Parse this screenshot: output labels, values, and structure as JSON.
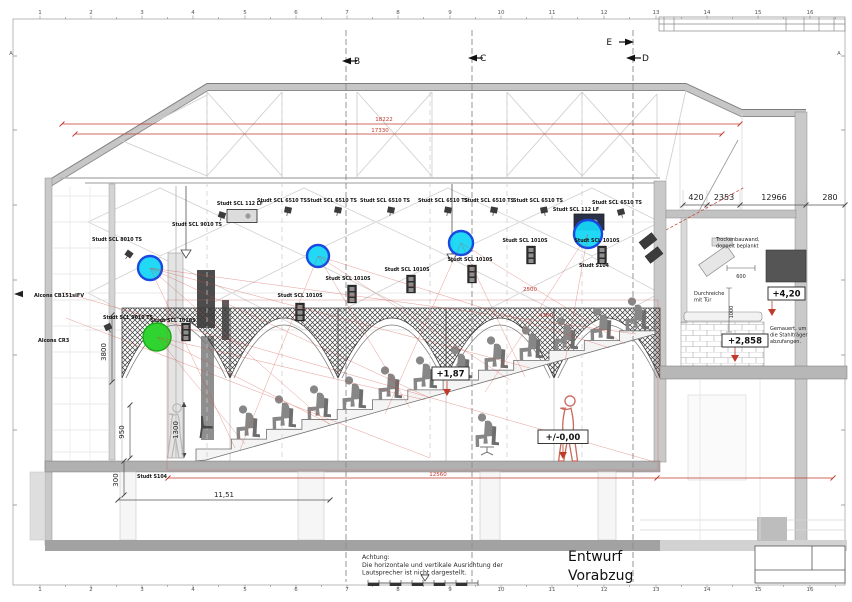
{
  "title_stamp": {
    "line1": "Entwurf",
    "line2": "Vorabzug"
  },
  "warning": {
    "l1": "Achtung:",
    "l2": "Die horizontale und vertikale Ausrichtung der",
    "l3": "Lautsprecher ist nicht dargestellt."
  },
  "colors": {
    "coverage_cyan": "#15d6f4",
    "coverage_ring": "#1a49e2",
    "coverage_green": "#30d430",
    "dim_red": "#c0392b"
  },
  "ruler": {
    "numbers": [
      "1",
      "2",
      "3",
      "4",
      "5",
      "6",
      "7",
      "8",
      "9",
      "10",
      "11",
      "12",
      "13",
      "14",
      "15",
      "16"
    ],
    "xs": [
      40,
      91,
      142,
      193,
      245,
      296,
      347,
      398,
      450,
      501,
      552,
      604,
      656,
      707,
      758,
      810
    ],
    "top_y": 14,
    "bottom_y": 591
  },
  "frame_letters": [
    {
      "t": "A",
      "x": 11,
      "y": 55
    },
    {
      "t": "A",
      "x": 839,
      "y": 55
    }
  ],
  "section_markers": [
    {
      "label": "B",
      "tx": 354,
      "ty": 64,
      "ax": 342,
      "ay": 61,
      "dir": "left",
      "lx": 346
    },
    {
      "label": "C",
      "tx": 480,
      "ty": 61,
      "ax": 468,
      "ay": 58,
      "dir": "left",
      "lx": 472
    },
    {
      "label": "E",
      "tx": 612,
      "ty": 45,
      "ax": 634,
      "ay": 42,
      "dir": "right",
      "lx": null,
      "anchor": "end"
    },
    {
      "label": "D",
      "tx": 642,
      "ty": 61,
      "ax": 626,
      "ay": 58,
      "dir": "left",
      "lx": 633
    }
  ],
  "texts": [
    {
      "t": "Studt SCL 8010 TS",
      "x": 117,
      "y": 241,
      "c": "sp",
      "n": "speaker-label"
    },
    {
      "t": "Studt SCL 9010 TS",
      "x": 197,
      "y": 226,
      "c": "sp",
      "n": "speaker-label"
    },
    {
      "t": "Studt SCL 112 LF",
      "x": 240,
      "y": 205,
      "c": "sp",
      "n": "speaker-label"
    },
    {
      "t": "Studt SCL 6510 TS",
      "x": 282,
      "y": 202,
      "c": "sp",
      "n": "speaker-label"
    },
    {
      "t": "Studt SCL 6510 TS",
      "x": 332,
      "y": 202,
      "c": "sp",
      "n": "speaker-label"
    },
    {
      "t": "Studt SCL 6510 TS",
      "x": 385,
      "y": 202,
      "c": "sp",
      "n": "speaker-label"
    },
    {
      "t": "Studt SCL 6510 TS",
      "x": 443,
      "y": 202,
      "c": "sp",
      "n": "speaker-label"
    },
    {
      "t": "Studt SCL 6510 TS",
      "x": 489,
      "y": 202,
      "c": "sp",
      "n": "speaker-label"
    },
    {
      "t": "Studt SCL 6510 TS",
      "x": 538,
      "y": 202,
      "c": "sp",
      "n": "speaker-label"
    },
    {
      "t": "Studt SCL 6510 TS",
      "x": 617,
      "y": 204,
      "c": "sp",
      "n": "speaker-label"
    },
    {
      "t": "Studt SCL 112 LF",
      "x": 576,
      "y": 211,
      "c": "sp",
      "n": "speaker-label"
    },
    {
      "t": "Studt SCL 9010 TS",
      "x": 128,
      "y": 319,
      "c": "sp",
      "n": "speaker-label"
    },
    {
      "t": "Studt SCL 1010S",
      "x": 173,
      "y": 322,
      "c": "sp",
      "n": "speaker-label"
    },
    {
      "t": "Studt SCL 1010S",
      "x": 300,
      "y": 297,
      "c": "sp",
      "n": "speaker-label"
    },
    {
      "t": "Studt SCL 1010S",
      "x": 348,
      "y": 280,
      "c": "sp",
      "n": "speaker-label"
    },
    {
      "t": "Studt SCL 1010S",
      "x": 407,
      "y": 271,
      "c": "sp",
      "n": "speaker-label"
    },
    {
      "t": "Studt SCL 1010S",
      "x": 470,
      "y": 261,
      "c": "sp",
      "n": "speaker-label"
    },
    {
      "t": "Studt SCL 1010S",
      "x": 525,
      "y": 242,
      "c": "sp",
      "n": "speaker-label"
    },
    {
      "t": "Studt SCL 1010S",
      "x": 597,
      "y": 242,
      "c": "sp",
      "n": "speaker-label"
    },
    {
      "t": "Studt S104",
      "x": 594,
      "y": 267,
      "c": "sp",
      "n": "speaker-label"
    },
    {
      "t": "Studt S104",
      "x": 152,
      "y": 478,
      "c": "sp",
      "n": "speaker-label"
    },
    {
      "t": "420",
      "x": 696,
      "y": 200,
      "c": "dim",
      "n": "dimension"
    },
    {
      "t": "2353",
      "x": 724,
      "y": 200,
      "c": "dim",
      "n": "dimension"
    },
    {
      "t": "12966",
      "x": 774,
      "y": 200,
      "c": "dim",
      "n": "dimension"
    },
    {
      "t": "280",
      "x": 830,
      "y": 200,
      "c": "dim",
      "n": "dimension"
    },
    {
      "t": "600",
      "x": 741,
      "y": 278,
      "c": "dimS",
      "n": "dimension"
    },
    {
      "t": "1000",
      "x": 733,
      "y": 312,
      "c": "dimS",
      "r": -90,
      "n": "dimension"
    },
    {
      "t": "3800",
      "x": 106,
      "y": 352,
      "c": "dim7",
      "r": -90,
      "n": "dimension"
    },
    {
      "t": "950",
      "x": 124,
      "y": 432,
      "c": "dim7",
      "r": -90,
      "n": "dimension"
    },
    {
      "t": "1300",
      "x": 178,
      "y": 430,
      "c": "dim7",
      "r": -90,
      "n": "dimension"
    },
    {
      "t": "300",
      "x": 118,
      "y": 480,
      "c": "dim7",
      "r": -90,
      "n": "dimension"
    },
    {
      "t": "11,51",
      "x": 224,
      "y": 497,
      "c": "dim7",
      "n": "dimension"
    },
    {
      "t": "18222",
      "x": 384,
      "y": 121,
      "c": "dimR",
      "n": "dimension-red"
    },
    {
      "t": "17330",
      "x": 380,
      "y": 132,
      "c": "dimR",
      "n": "dimension-red"
    },
    {
      "t": "12560",
      "x": 438,
      "y": 476,
      "c": "dimR",
      "n": "dimension-red"
    },
    {
      "t": "2500",
      "x": 530,
      "y": 291,
      "c": "dimR",
      "n": "dimension-red"
    },
    {
      "t": "4260",
      "x": 546,
      "y": 317,
      "c": "dimR",
      "n": "dimension-red"
    },
    {
      "t": "Trockenbauwand,",
      "x": 716,
      "y": 241,
      "c": "note",
      "a": "start",
      "n": "annotation"
    },
    {
      "t": "doppelt beplankt",
      "x": 716,
      "y": 247.5,
      "c": "note",
      "a": "start",
      "n": "annotation"
    },
    {
      "t": "Durchreiche",
      "x": 694,
      "y": 295,
      "c": "note",
      "a": "start",
      "n": "annotation"
    },
    {
      "t": "mit Tür",
      "x": 694,
      "y": 301.5,
      "c": "note",
      "a": "start",
      "n": "annotation"
    },
    {
      "t": "Gemauert, um",
      "x": 770,
      "y": 330,
      "c": "note",
      "a": "start",
      "n": "annotation"
    },
    {
      "t": "die Stahlträger",
      "x": 770,
      "y": 336.5,
      "c": "note",
      "a": "start",
      "n": "annotation"
    },
    {
      "t": "abzufangen.",
      "x": 770,
      "y": 343,
      "c": "note",
      "a": "start",
      "n": "annotation"
    },
    {
      "t": "Alcons CB151slFV",
      "x": 34,
      "y": 297,
      "c": "alc",
      "a": "start",
      "n": "speaker-label"
    },
    {
      "t": "Alcons CR3",
      "x": 38,
      "y": 342,
      "c": "alc",
      "a": "start",
      "n": "speaker-label"
    }
  ],
  "elevations": [
    {
      "t": "+4,20",
      "x": 768,
      "y": 287,
      "w": 37,
      "h": 13
    },
    {
      "t": "+2,858",
      "x": 722,
      "y": 334,
      "w": 46,
      "h": 13
    },
    {
      "t": "+1,87",
      "x": 432,
      "y": 367,
      "w": 37,
      "h": 13
    },
    {
      "t": "+/-0,00",
      "x": 538,
      "y": 430,
      "w": 50,
      "h": 13.5
    }
  ],
  "icons": [
    {
      "k": "cube",
      "x": 129,
      "y": 254,
      "r": 35,
      "n": "speaker-icon"
    },
    {
      "k": "cube",
      "x": 222,
      "y": 215,
      "r": 18,
      "n": "speaker-icon"
    },
    {
      "k": "lf",
      "x": 242,
      "y": 216,
      "n": "subwoofer-icon"
    },
    {
      "k": "cube",
      "x": 288,
      "y": 210,
      "r": 12,
      "n": "speaker-icon"
    },
    {
      "k": "cube",
      "x": 338,
      "y": 210,
      "r": 12,
      "n": "speaker-icon"
    },
    {
      "k": "cube",
      "x": 391,
      "y": 210,
      "r": 12,
      "n": "speaker-icon"
    },
    {
      "k": "cube",
      "x": 448,
      "y": 210,
      "r": 12,
      "n": "speaker-icon"
    },
    {
      "k": "cube",
      "x": 494,
      "y": 210,
      "r": 12,
      "n": "speaker-icon"
    },
    {
      "k": "cube",
      "x": 544,
      "y": 210,
      "r": -12,
      "n": "speaker-icon"
    },
    {
      "k": "cube",
      "x": 621,
      "y": 212,
      "r": -15,
      "n": "speaker-icon"
    },
    {
      "k": "lfd",
      "x": 589,
      "y": 222,
      "n": "subwoofer-icon"
    },
    {
      "k": "cube",
      "x": 108,
      "y": 327,
      "r": -25,
      "n": "speaker-icon"
    },
    {
      "k": "arr",
      "x": 186,
      "y": 332,
      "n": "column-speaker-icon"
    },
    {
      "k": "arr",
      "x": 300,
      "y": 312,
      "n": "column-speaker-icon"
    },
    {
      "k": "arr",
      "x": 352,
      "y": 294,
      "n": "column-speaker-icon"
    },
    {
      "k": "arr",
      "x": 411,
      "y": 284,
      "n": "column-speaker-icon"
    },
    {
      "k": "arr",
      "x": 472,
      "y": 274,
      "n": "column-speaker-icon"
    },
    {
      "k": "arr",
      "x": 531,
      "y": 255,
      "n": "column-speaker-icon"
    },
    {
      "k": "arr",
      "x": 602,
      "y": 255,
      "n": "column-speaker-icon"
    },
    {
      "k": "wall",
      "x": 648,
      "y": 241,
      "r": -38,
      "n": "wall-speaker-icon"
    },
    {
      "k": "wall",
      "x": 654,
      "y": 255,
      "r": -38,
      "n": "wall-speaker-icon"
    },
    {
      "k": "pole",
      "x": 186,
      "top": 186,
      "y": 250,
      "n": "hanging-speaker-icon"
    },
    {
      "k": "pole",
      "x": 452,
      "top": 184,
      "y": 254,
      "n": "hanging-speaker-icon"
    },
    {
      "k": "circ",
      "x": 150,
      "y": 268,
      "rad": 12,
      "n": "coverage-marker-cyan"
    },
    {
      "k": "circ",
      "x": 318,
      "y": 256,
      "rad": 11,
      "n": "coverage-marker-cyan"
    },
    {
      "k": "circ",
      "x": 461,
      "y": 243,
      "rad": 12,
      "n": "coverage-marker-cyan"
    },
    {
      "k": "circ",
      "x": 588,
      "y": 234,
      "rad": 14,
      "n": "coverage-marker-cyan"
    },
    {
      "k": "circg",
      "x": 157,
      "y": 337,
      "rad": 14,
      "n": "coverage-marker-green"
    },
    {
      "k": "rmark",
      "x": 447,
      "y": 389,
      "n": "level-marker"
    },
    {
      "k": "rmark",
      "x": 563,
      "y": 452,
      "n": "level-marker"
    },
    {
      "k": "rmark",
      "x": 735,
      "y": 355,
      "n": "level-marker"
    },
    {
      "k": "rmark",
      "x": 772,
      "y": 309,
      "n": "level-marker"
    }
  ],
  "figures": {
    "seated": [
      [
        248,
        439
      ],
      [
        284,
        429
      ],
      [
        319,
        419
      ],
      [
        354,
        410
      ],
      [
        390,
        400
      ],
      [
        425,
        390
      ],
      [
        460,
        380
      ],
      [
        496,
        370
      ],
      [
        531,
        360
      ],
      [
        566,
        351
      ],
      [
        602,
        341
      ],
      [
        637,
        331
      ]
    ],
    "chair_person": [
      487,
      455
    ],
    "empty_chair": [
      207,
      438
    ],
    "standing_gray": [
      177,
      458
    ],
    "standing_red": [
      570,
      461
    ]
  }
}
